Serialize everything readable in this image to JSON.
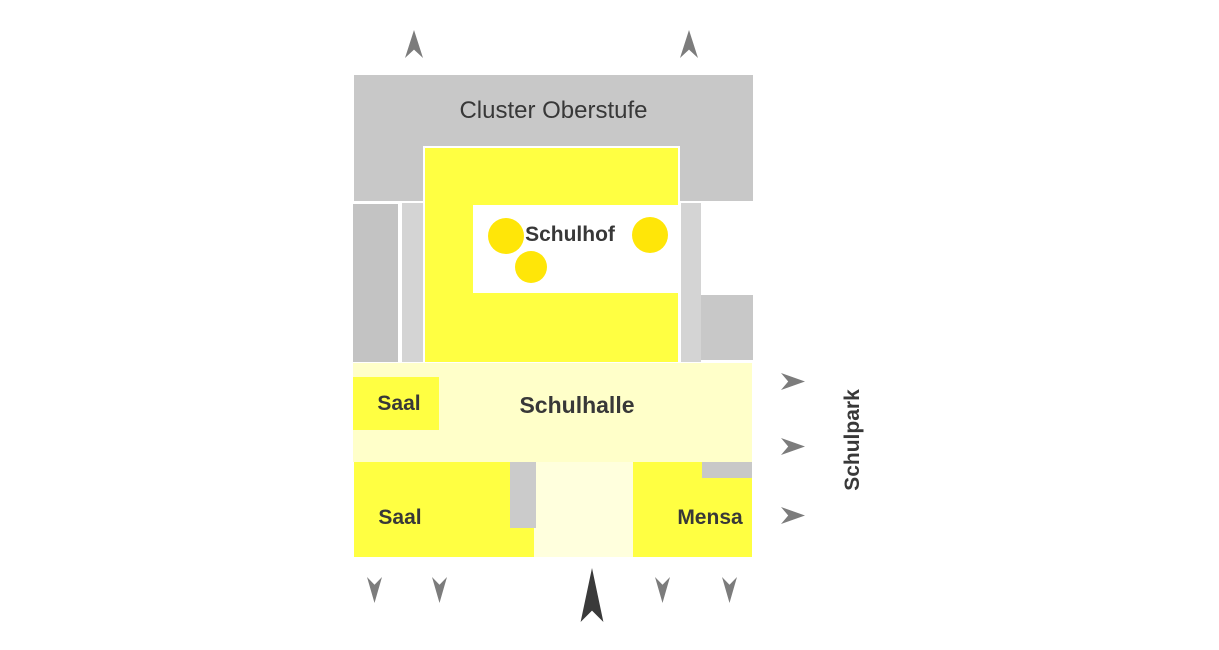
{
  "diagram": {
    "type": "school-site-plan",
    "labels": {
      "cluster": "Cluster Oberstufe",
      "schulhof": "Schulhof",
      "schulhalle": "Schulhalle",
      "saal_upper": "Saal",
      "saal_lower": "Saal",
      "mensa": "Mensa",
      "schulpark": "Schulpark"
    },
    "icons": {
      "tree": "yellow-circle",
      "up_arrow": "gray-dart-up",
      "down_arrow": "gray-dart-down",
      "right_arrow": "gray-dart-right",
      "north_arrow": "black-dart-up"
    },
    "counts": {
      "trees": 3,
      "up_arrows": 2,
      "down_arrows": 4,
      "right_arrows": 3
    }
  },
  "palette": {
    "building_yellow": "#ffff42",
    "tree_yellow": "#ffe608",
    "hall_pale": "#ffffc9",
    "corridor_pale": "#ffffdd",
    "block_gray": "#c8c8c8",
    "dark_strip_gray": "#c3c3c3",
    "light_strip_gray": "#d4d4d4",
    "small_gray": "#cbcbcb",
    "arrow_gray": "#7c7c7c",
    "north_dark": "#3a3a3a",
    "label_color": "#383838"
  }
}
